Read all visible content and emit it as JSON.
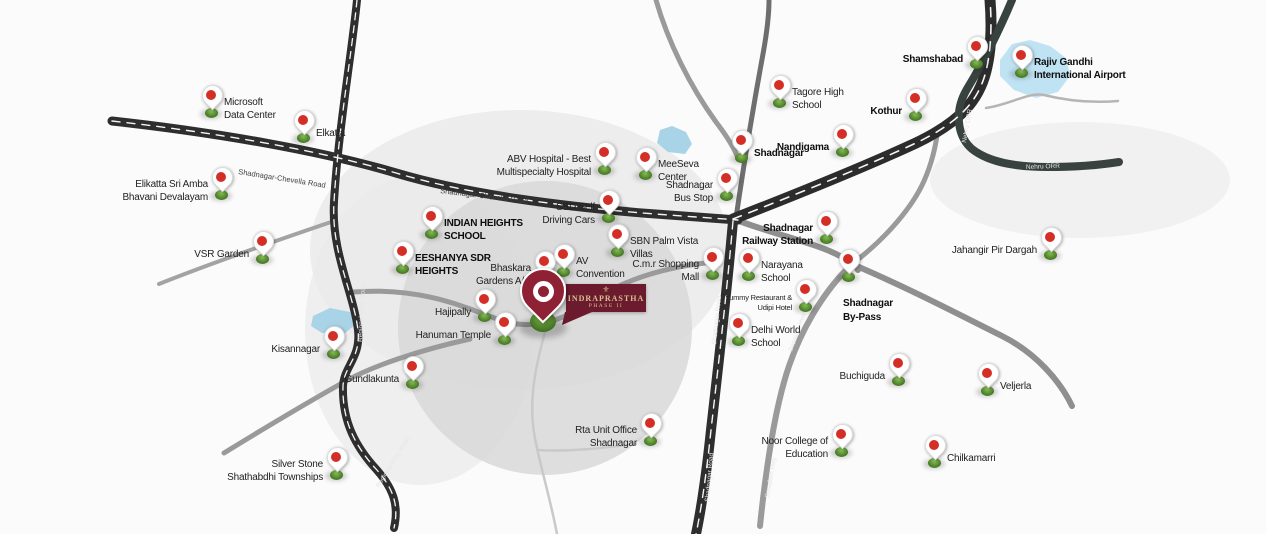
{
  "property": {
    "flag_line1": "INDRAPRASTHA",
    "flag_line2": "PHASE II",
    "crest_glyph": "⚜"
  },
  "locations": [
    {
      "id": "microsoft-data-center",
      "lines": [
        "Microsoft",
        "Data Center"
      ],
      "x": 211,
      "y": 117,
      "side": "right",
      "bold": false,
      "small": false
    },
    {
      "id": "elkatta",
      "lines": [
        "Elkatta"
      ],
      "x": 303,
      "y": 142,
      "side": "right",
      "bold": false,
      "small": false
    },
    {
      "id": "elikatta-sri-amba-bhavani-devalayam",
      "lines": [
        "Elikatta Sri Amba",
        "Bhavani Devalayam"
      ],
      "x": 221,
      "y": 199,
      "side": "left",
      "bold": false,
      "small": false
    },
    {
      "id": "vsr-garden",
      "lines": [
        "VSR Garden"
      ],
      "x": 262,
      "y": 263,
      "side": "left",
      "bold": false,
      "small": false
    },
    {
      "id": "kisannagar",
      "lines": [
        "Kisannagar"
      ],
      "x": 333,
      "y": 358,
      "side": "left",
      "bold": false,
      "small": false
    },
    {
      "id": "gundlakunta",
      "lines": [
        "Gundlakunta"
      ],
      "x": 412,
      "y": 388,
      "side": "left",
      "bold": false,
      "small": false
    },
    {
      "id": "silver-stone-shathabdhi-townships",
      "lines": [
        "Silver Stone",
        "Shathabdhi Townships"
      ],
      "x": 336,
      "y": 479,
      "side": "left",
      "bold": false,
      "small": false
    },
    {
      "id": "indian-heights-school",
      "lines": [
        "INDIAN HEIGHTS",
        "SCHOOL"
      ],
      "x": 431,
      "y": 238,
      "side": "right",
      "bold": true,
      "small": false
    },
    {
      "id": "eeshanya-sdr-heights",
      "lines": [
        "EESHANYA SDR",
        "HEIGHTS"
      ],
      "x": 402,
      "y": 273,
      "side": "right",
      "bold": true,
      "small": false
    },
    {
      "id": "hajipally",
      "lines": [
        "Hajipally"
      ],
      "x": 484,
      "y": 321,
      "side": "left",
      "bold": false,
      "small": false
    },
    {
      "id": "hanuman-temple",
      "lines": [
        "Hanuman Temple"
      ],
      "x": 504,
      "y": 344,
      "side": "left",
      "bold": false,
      "small": false
    },
    {
      "id": "bhaskara-gardens",
      "lines": [
        "Bhaskara",
        "Gardens A/C"
      ],
      "x": 544,
      "y": 283,
      "side": "left",
      "bold": false,
      "small": false
    },
    {
      "id": "av-convention",
      "lines": [
        "AV",
        "Convention"
      ],
      "x": 563,
      "y": 276,
      "side": "right",
      "bold": false,
      "small": false
    },
    {
      "id": "ssd-self-driving-cars",
      "lines": [
        "SSD Self",
        "Driving Cars"
      ],
      "x": 608,
      "y": 222,
      "side": "left",
      "bold": false,
      "small": false
    },
    {
      "id": "sbn-palm-vista-villas",
      "lines": [
        "SBN Palm Vista",
        "Villas"
      ],
      "x": 617,
      "y": 256,
      "side": "right",
      "bold": false,
      "small": false
    },
    {
      "id": "abv-hospital",
      "lines": [
        "ABV Hospital - Best",
        "Multispecialty Hospital"
      ],
      "x": 604,
      "y": 174,
      "side": "left",
      "bold": false,
      "small": false
    },
    {
      "id": "meeseva-center",
      "lines": [
        "MeeSeva",
        "Center"
      ],
      "x": 645,
      "y": 179,
      "side": "right",
      "bold": false,
      "small": false
    },
    {
      "id": "shadnagar-bus-stop",
      "lines": [
        "Shadnagar",
        "Bus Stop"
      ],
      "x": 726,
      "y": 200,
      "side": "left",
      "bold": false,
      "small": false
    },
    {
      "id": "cmr-shopping-mall",
      "lines": [
        "C.m.r Shopping",
        "Mall"
      ],
      "x": 712,
      "y": 279,
      "side": "left",
      "bold": false,
      "small": false
    },
    {
      "id": "narayana-school",
      "lines": [
        "Narayana",
        "School"
      ],
      "x": 748,
      "y": 280,
      "side": "right",
      "bold": false,
      "small": false
    },
    {
      "id": "yummy-restaurant-udipi-hotel",
      "lines": [
        "Yummy Restaurant &",
        "Udipi Hotel"
      ],
      "x": 805,
      "y": 311,
      "side": "left",
      "bold": false,
      "small": true
    },
    {
      "id": "delhi-world-school",
      "lines": [
        "Delhi World",
        "School"
      ],
      "x": 738,
      "y": 345,
      "side": "right",
      "bold": false,
      "small": false
    },
    {
      "id": "shadnagar-railway-station",
      "lines": [
        "Shadnagar",
        "Railway Station"
      ],
      "x": 826,
      "y": 243,
      "side": "left",
      "bold": true,
      "small": false
    },
    {
      "id": "shadnagar-by-pass",
      "lines": [
        "Shadnagar",
        "By-Pass"
      ],
      "x": 848,
      "y": 281,
      "side": "below",
      "bold": true,
      "small": false
    },
    {
      "id": "shadnagar-town",
      "lines": [
        "Shadnagar"
      ],
      "x": 741,
      "y": 162,
      "side": "right",
      "bold": true,
      "small": false
    },
    {
      "id": "tagore-high-school",
      "lines": [
        "Tagore High",
        "School"
      ],
      "x": 779,
      "y": 107,
      "side": "right",
      "bold": false,
      "small": false
    },
    {
      "id": "nandigama",
      "lines": [
        "Nandigama"
      ],
      "x": 842,
      "y": 156,
      "side": "left",
      "bold": true,
      "small": false
    },
    {
      "id": "kothur",
      "lines": [
        "Kothur"
      ],
      "x": 915,
      "y": 120,
      "side": "left",
      "bold": true,
      "small": false
    },
    {
      "id": "shamshabad",
      "lines": [
        "Shamshabad"
      ],
      "x": 976,
      "y": 68,
      "side": "left",
      "bold": true,
      "small": false
    },
    {
      "id": "rajiv-gandhi-international-airport",
      "lines": [
        "Rajiv Gandhi",
        "International Airport"
      ],
      "x": 1021,
      "y": 77,
      "side": "right",
      "bold": true,
      "small": false
    },
    {
      "id": "jahangir-pir-dargah",
      "lines": [
        "Jahangir Pir Dargah"
      ],
      "x": 1050,
      "y": 259,
      "side": "left",
      "bold": false,
      "small": false
    },
    {
      "id": "buchiguda",
      "lines": [
        "Buchiguda"
      ],
      "x": 898,
      "y": 385,
      "side": "left",
      "bold": false,
      "small": false
    },
    {
      "id": "veljerla",
      "lines": [
        "Veljerla"
      ],
      "x": 987,
      "y": 395,
      "side": "right",
      "bold": false,
      "small": false
    },
    {
      "id": "noor-college-of-education",
      "lines": [
        "Noor College of",
        "Education"
      ],
      "x": 841,
      "y": 456,
      "side": "left",
      "bold": false,
      "small": false
    },
    {
      "id": "chilkamarri",
      "lines": [
        "Chilkamarri"
      ],
      "x": 934,
      "y": 467,
      "side": "right",
      "bold": false,
      "small": false
    },
    {
      "id": "rta-unit-office-shadnagar",
      "lines": [
        "Rta Unit Office",
        "Shadnagar"
      ],
      "x": 650,
      "y": 445,
      "side": "left",
      "bold": false,
      "small": false
    }
  ],
  "road_labels": [
    {
      "text": "Shadnagar-Chevella Road",
      "x": 238,
      "y": 174,
      "rotate": 9,
      "light": false
    },
    {
      "text": "Shadnagar-Chevella Road",
      "x": 440,
      "y": 193,
      "rotate": 7,
      "light": false
    },
    {
      "text": "Nehru ORR",
      "x": 1026,
      "y": 169,
      "rotate": -2,
      "light": true
    },
    {
      "text": "Nehru ORR",
      "x": 966,
      "y": 143,
      "rotate": -80,
      "light": true
    },
    {
      "text": "Shadnagar Road",
      "x": 716,
      "y": 345,
      "rotate": -84,
      "light": true
    },
    {
      "text": "Shadnagar Road",
      "x": 709,
      "y": 502,
      "rotate": -85,
      "light": true
    },
    {
      "text": "Regional Ring Road",
      "x": 362,
      "y": 342,
      "rotate": -87,
      "light": true
    },
    {
      "text": "Regional Ring Road",
      "x": 379,
      "y": 488,
      "rotate": -58,
      "light": true
    },
    {
      "text": "Srisailam Hwy",
      "x": 792,
      "y": 352,
      "rotate": -70,
      "light": true
    },
    {
      "text": "Srisailam Hwy",
      "x": 769,
      "y": 498,
      "rotate": -80,
      "light": true
    }
  ],
  "colors": {
    "pin_red": "#d32f27",
    "pin_base_green": "#5a8f33",
    "property_maroon": "#8e2134",
    "flag_maroon": "#6c1b2e",
    "flag_text_gold": "#d6c08f",
    "road_dark": "#2e2e2e",
    "road_gray": "#9a9a9a",
    "lake_blue": "#a9d3e7",
    "radius_circle_gray": "#d7d7d7"
  }
}
